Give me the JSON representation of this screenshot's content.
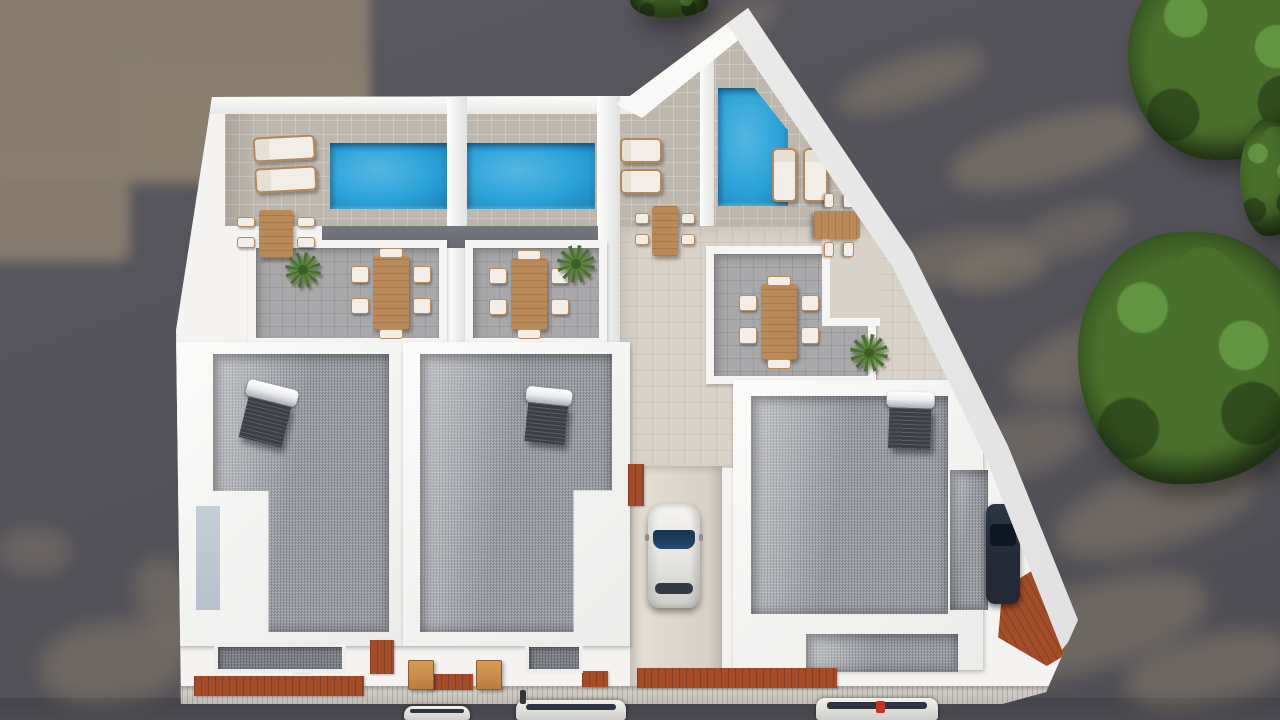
{
  "meta": {
    "title": "aerial-3d-architectural-render-of-white-villa-complex",
    "canvas": {
      "w": 1280,
      "h": 720
    },
    "description": "Top-down 3D render: white multi-unit residence with three rooftop pools, sun loungers, wooden dining sets, gravel roofs with solar water heaters, central driveway with parked car, street with parked cars below, trees on the right."
  },
  "palette": {
    "ground": "#54535a",
    "ground_shadow_tan": "#8b7f6e",
    "street": "#4b4a50",
    "building_white": "#f4f3f1",
    "terrace_tile": "#beb7ad",
    "walkway_tile": "#d8d2c8",
    "driveway": "#e0dad0",
    "gray_tile": "#a9a9ab",
    "roof_strip": "#686b71",
    "balcony_gravel": "#7d7f88",
    "pool_blue": "#2ba3d9",
    "pool_light": "#55b5e2",
    "pool_deep": "#1b7fb4",
    "wood": "#b98a58",
    "cushion": "#f2eee7",
    "deck_terracotta": "#a34c29",
    "solar_panel": "#3a3e45",
    "solar_tank": "#e9eaee",
    "car_body": "#e9e8e5",
    "car_glass": "#27496b",
    "car_dark": "#232a36",
    "tree_dark": "#2f4d1e",
    "tree_mid": "#49712c",
    "tree_light": "#639441",
    "lightwell": "#b7c0cb",
    "accent_red": "#c2342a"
  },
  "ground_shadows": [
    {
      "x": -20,
      "y": -20,
      "w": 390,
      "h": 200,
      "rot": 0,
      "op": 0.95,
      "blur": 6,
      "rect": true
    },
    {
      "x": -20,
      "y": 150,
      "w": 150,
      "h": 112,
      "rot": 0,
      "op": 0.9,
      "blur": 6,
      "rect": true
    },
    {
      "x": 120,
      "y": 60,
      "w": 240,
      "h": 120,
      "rot": 0,
      "op": 0.85,
      "blur": 9,
      "rect": true
    },
    {
      "x": 690,
      "y": 8,
      "w": 90,
      "h": 30,
      "rot": -20,
      "op": 0.45,
      "blur": 9
    },
    {
      "x": 836,
      "y": 58,
      "w": 150,
      "h": 46,
      "rot": -18,
      "op": 0.5,
      "blur": 9
    },
    {
      "x": 948,
      "y": 120,
      "w": 200,
      "h": 60,
      "rot": -15,
      "op": 0.55,
      "blur": 9
    },
    {
      "x": 872,
      "y": 235,
      "w": 150,
      "h": 48,
      "rot": -12,
      "op": 0.45,
      "blur": 9
    },
    {
      "x": 1010,
      "y": 210,
      "w": 120,
      "h": 44,
      "rot": -18,
      "op": 0.4,
      "blur": 9
    },
    {
      "x": 950,
      "y": 248,
      "w": 95,
      "h": 42,
      "rot": -10,
      "op": 0.5,
      "blur": 8
    },
    {
      "x": 1006,
      "y": 318,
      "w": 210,
      "h": 70,
      "rot": -18,
      "op": 0.5,
      "blur": 10
    },
    {
      "x": 918,
      "y": 420,
      "w": 170,
      "h": 60,
      "rot": -14,
      "op": 0.45,
      "blur": 10
    },
    {
      "x": 1052,
      "y": 470,
      "w": 210,
      "h": 76,
      "rot": -18,
      "op": 0.5,
      "blur": 10
    },
    {
      "x": 980,
      "y": 584,
      "w": 230,
      "h": 84,
      "rot": -16,
      "op": 0.5,
      "blur": 10
    },
    {
      "x": 1124,
      "y": 636,
      "w": 170,
      "h": 66,
      "rot": -12,
      "op": 0.5,
      "blur": 10
    },
    {
      "x": 820,
      "y": 660,
      "w": 140,
      "h": 50,
      "rot": -10,
      "op": 0.35,
      "blur": 10
    },
    {
      "x": 40,
      "y": 622,
      "w": 150,
      "h": 80,
      "rot": -8,
      "op": 0.5,
      "blur": 10
    },
    {
      "x": 0,
      "y": 528,
      "w": 70,
      "h": 46,
      "rot": 0,
      "op": 0.4,
      "blur": 9
    },
    {
      "x": 140,
      "y": 556,
      "w": 60,
      "h": 90,
      "rot": -30,
      "op": 0.45,
      "blur": 9
    }
  ],
  "trees": [
    {
      "name": "tree-cluster-top-right",
      "x": 1128,
      "y": -46,
      "w": 206,
      "h": 206
    },
    {
      "name": "tree-cluster-right-small",
      "x": 1240,
      "y": 118,
      "w": 64,
      "h": 118
    },
    {
      "name": "tree-cluster-right-large",
      "x": 1078,
      "y": 232,
      "w": 230,
      "h": 252
    },
    {
      "name": "tree-tuft-top-center",
      "x": 630,
      "y": -16,
      "w": 78,
      "h": 34
    }
  ],
  "building_items": [
    {
      "type": "pool",
      "name": "swimming-pool-left",
      "x": 330,
      "y": 143,
      "w": 117,
      "h": 66
    },
    {
      "type": "pool",
      "name": "swimming-pool-middle",
      "x": 467,
      "y": 143,
      "w": 128,
      "h": 66
    },
    {
      "type": "pool",
      "name": "swimming-pool-right-clipped",
      "x": 718,
      "y": 88,
      "w": 70,
      "h": 118,
      "variant": "clipped"
    },
    {
      "type": "lounger-pair",
      "name": "sun-loungers-left",
      "x": 254,
      "y": 136,
      "w": 62,
      "h": 56,
      "dir": "h",
      "rot": -3
    },
    {
      "type": "lounger-pair",
      "name": "sun-loungers-center",
      "x": 620,
      "y": 138,
      "w": 42,
      "h": 56,
      "dir": "h",
      "rot": 0
    },
    {
      "type": "lounger-pair",
      "name": "sun-loungers-right",
      "x": 772,
      "y": 148,
      "w": 56,
      "h": 54,
      "dir": "v",
      "rot": 0
    },
    {
      "type": "dining-set",
      "name": "dining-set-terrace-a",
      "x": 238,
      "y": 206,
      "w": 76,
      "h": 56,
      "head": false
    },
    {
      "type": "dining-set",
      "name": "dining-set-patio-left",
      "x": 352,
      "y": 250,
      "w": 78,
      "h": 86,
      "head": true
    },
    {
      "type": "dining-set",
      "name": "dining-set-patio-mid",
      "x": 490,
      "y": 252,
      "w": 78,
      "h": 84,
      "head": true
    },
    {
      "type": "dining-set",
      "name": "dining-set-walkway",
      "x": 636,
      "y": 202,
      "w": 58,
      "h": 58,
      "head": false
    },
    {
      "type": "dining-set",
      "name": "dining-set-pool-right",
      "x": 806,
      "y": 198,
      "w": 62,
      "h": 54,
      "head": false,
      "orient": "h"
    },
    {
      "type": "dining-set",
      "name": "dining-set-patio-right",
      "x": 740,
      "y": 278,
      "w": 78,
      "h": 88,
      "head": true
    },
    {
      "type": "plant",
      "name": "potted-plant-left",
      "x": 285,
      "y": 252,
      "s": 36
    },
    {
      "type": "plant",
      "name": "potted-plant-mid",
      "x": 557,
      "y": 245,
      "s": 38
    },
    {
      "type": "plant",
      "name": "potted-plant-right",
      "x": 850,
      "y": 334,
      "s": 38
    },
    {
      "type": "solar",
      "name": "solar-water-heater-roof1",
      "x": 241,
      "y": 384,
      "w": 52,
      "h": 60,
      "rot": 14
    },
    {
      "type": "solar",
      "name": "solar-water-heater-roof2",
      "x": 524,
      "y": 388,
      "w": 46,
      "h": 56,
      "rot": 6
    },
    {
      "type": "solar",
      "name": "solar-water-heater-roof3",
      "x": 886,
      "y": 392,
      "w": 48,
      "h": 58,
      "rot": 2
    },
    {
      "type": "deck",
      "name": "wood-deck-driveway-top",
      "x": 628,
      "y": 464,
      "w": 16,
      "h": 42
    },
    {
      "type": "deck",
      "name": "wood-deck-bottom-left",
      "x": 194,
      "y": 676,
      "w": 170,
      "h": 20
    },
    {
      "type": "deck",
      "name": "wood-deck-strip-1",
      "x": 292,
      "y": 644,
      "w": 18,
      "h": 28
    },
    {
      "type": "deck",
      "name": "wood-deck-strip-2",
      "x": 370,
      "y": 640,
      "w": 24,
      "h": 34
    },
    {
      "type": "deck",
      "name": "wood-deck-strip-3",
      "x": 427,
      "y": 674,
      "w": 46,
      "h": 16
    },
    {
      "type": "deck",
      "name": "wood-deck-strip-4",
      "x": 582,
      "y": 671,
      "w": 26,
      "h": 16
    },
    {
      "type": "deck",
      "name": "wood-deck-bottom-center",
      "x": 637,
      "y": 668,
      "w": 200,
      "h": 20
    },
    {
      "type": "bench",
      "name": "wood-bench-1",
      "x": 408,
      "y": 660,
      "w": 26,
      "h": 30
    },
    {
      "type": "bench",
      "name": "wood-bench-2",
      "x": 476,
      "y": 660,
      "w": 26,
      "h": 30
    },
    {
      "type": "bgravel",
      "name": "balcony-gravel-left",
      "x": 214,
      "y": 643,
      "w": 132,
      "h": 30
    },
    {
      "type": "bgravel",
      "name": "balcony-gravel-mid",
      "x": 525,
      "y": 643,
      "w": 58,
      "h": 30
    }
  ],
  "vehicles": {
    "driveway_car": {
      "type": "car",
      "name": "white-car-driveway",
      "x": 648,
      "y": 504,
      "w": 52,
      "h": 104
    },
    "perimeter_car": {
      "type": "car-dark",
      "name": "dark-car-side-ramp",
      "x": 986,
      "y": 504,
      "w": 34,
      "h": 100
    },
    "street_cars": [
      {
        "type": "scar",
        "name": "street-car-1",
        "x": 404,
        "y": 706,
        "w": 66,
        "h": 14
      },
      {
        "type": "scar",
        "name": "street-car-2",
        "x": 516,
        "y": 700,
        "w": 110,
        "h": 20
      },
      {
        "type": "scar",
        "name": "street-car-3",
        "x": 816,
        "y": 698,
        "w": 122,
        "h": 22
      }
    ]
  },
  "small_objects": [
    {
      "type": "dot",
      "name": "red-hydrant",
      "x": 876,
      "y": 701,
      "w": 9,
      "h": 12,
      "color": "#c2342a"
    },
    {
      "type": "dot",
      "name": "street-pole",
      "x": 520,
      "y": 690,
      "w": 6,
      "h": 14,
      "color": "#33363b"
    }
  ]
}
